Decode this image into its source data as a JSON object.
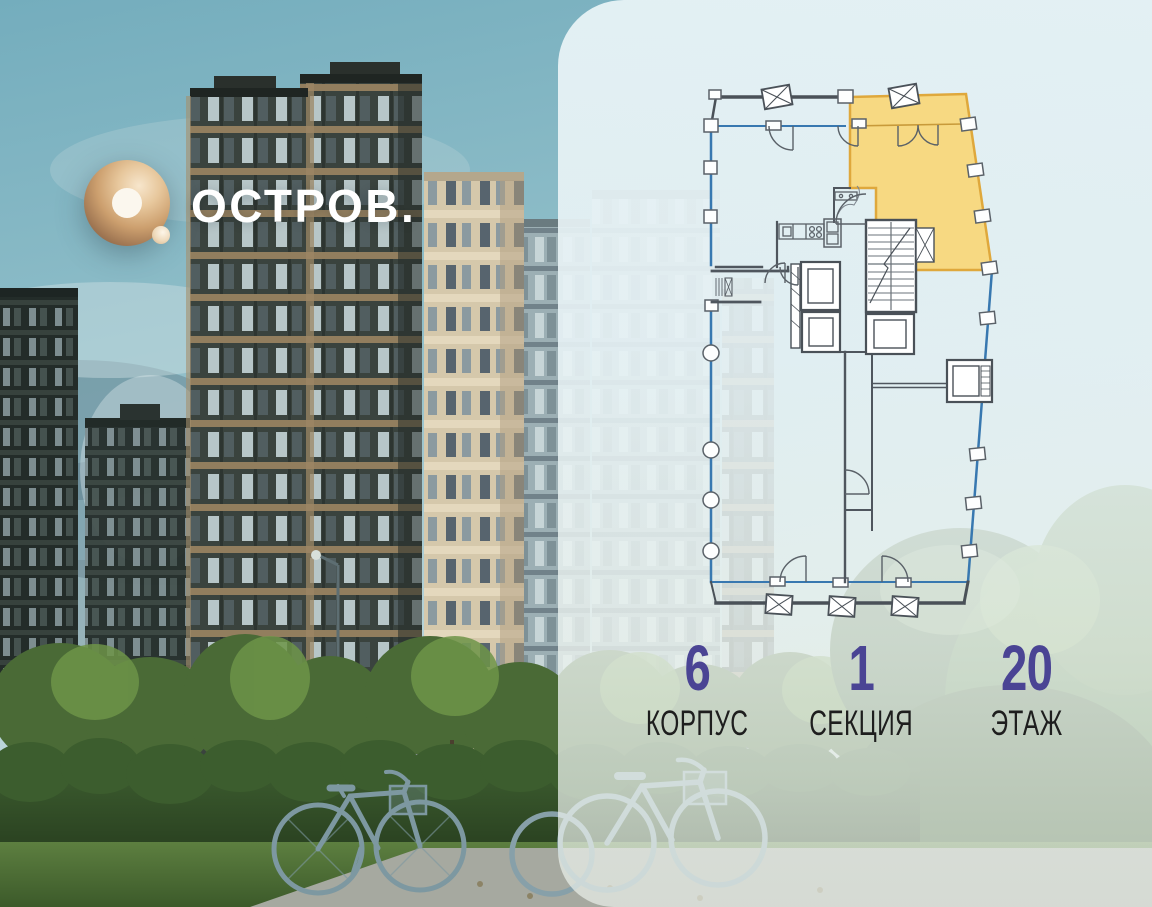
{
  "brand": {
    "wordmark": "ОСТРОВ.",
    "mark": "O-ring with dot"
  },
  "panel": {
    "background": "#E9F3F5"
  },
  "floor_plan": {
    "type": "residential floor plan, single section",
    "selected_apartment": {
      "position": "top-right",
      "fill": "#F8D77B",
      "border": "#DFA83C"
    },
    "outline_color": "#3878B0",
    "wall_color": "#4A5158"
  },
  "stats": {
    "value_color": "#4A4494",
    "label_color": "#1E1E1E",
    "items": [
      {
        "value": "6",
        "label": "КОРПУС"
      },
      {
        "value": "1",
        "label": "СЕКЦИЯ"
      },
      {
        "value": "20",
        "label": "ЭТАЖ"
      }
    ]
  }
}
